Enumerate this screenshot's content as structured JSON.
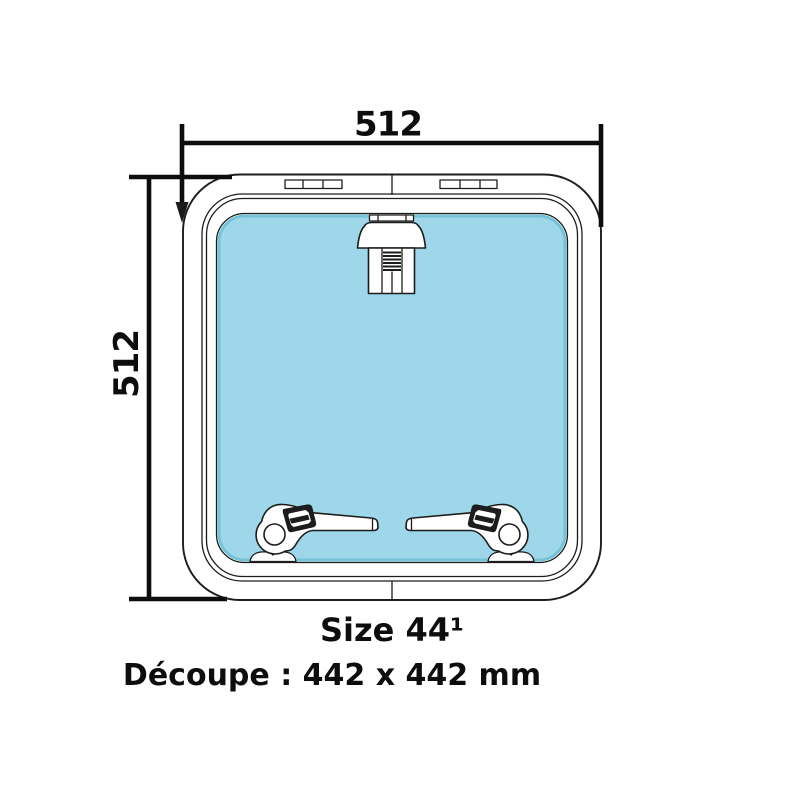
{
  "colors": {
    "page_bg": "#ffffff",
    "line": "#1c1c1c",
    "dim": "#0d0d0d",
    "glass_fill": "#9dd7e9",
    "glass_edge": "#76c3d9",
    "white": "#ffffff",
    "text": "#0d0d0d"
  },
  "dimensions": {
    "width_label": "512",
    "height_label": "512"
  },
  "caption": {
    "size": "Size 44¹",
    "cutout": "Découpe : 442 x 442 mm"
  },
  "parts": {
    "glass": "tinted acrylic pane",
    "top_fitting": "friction hinge stay",
    "bottom_fittings": "two locking handles"
  }
}
